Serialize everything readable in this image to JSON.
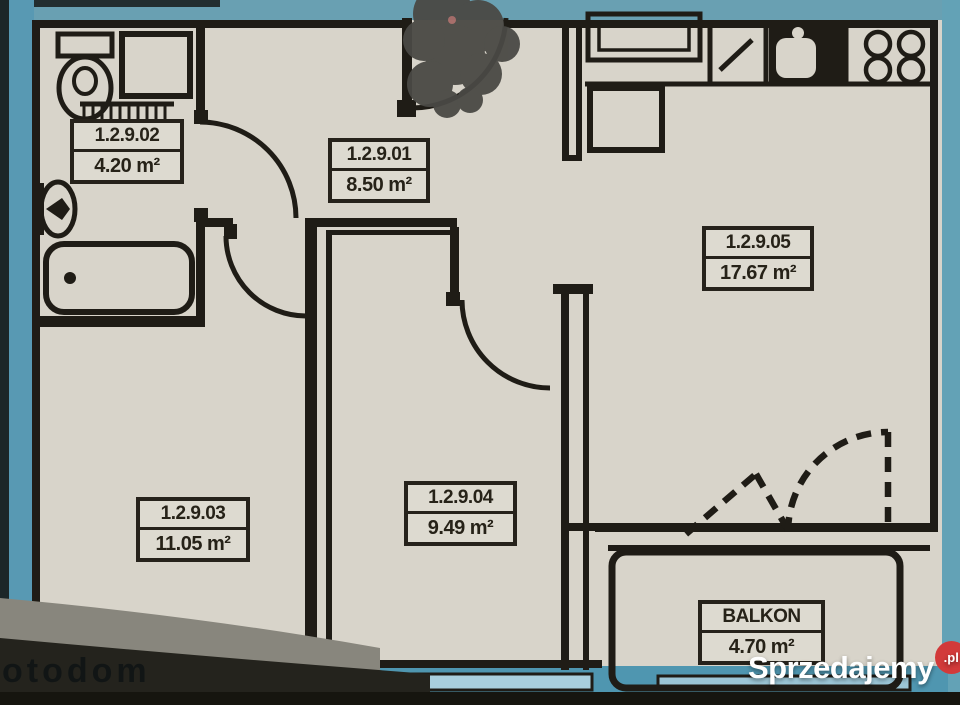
{
  "plan": {
    "rooms": [
      {
        "label": "1.2.9.02",
        "area": "4.20 m²"
      },
      {
        "label": "1.2.9.01",
        "area": "8.50 m²"
      },
      {
        "label": "1.2.9.05",
        "area": "17.67 m²"
      },
      {
        "label": "1.2.9.03",
        "area": "11.05 m²"
      },
      {
        "label": "1.2.9.04",
        "area": "9.49 m²"
      },
      {
        "label": "BALKON",
        "area": "4.70 m²"
      }
    ]
  },
  "watermarks": {
    "brand": "Sprzedajemy",
    "brand_suffix": ".pl",
    "corner_text": "otodom"
  },
  "colors": {
    "paper": "#d8d4ca",
    "ink": "#1f1c16",
    "highlighter_blue": "#5899b3",
    "window_blue": "#a9cfdd",
    "brand_red": "#d23a3a"
  }
}
